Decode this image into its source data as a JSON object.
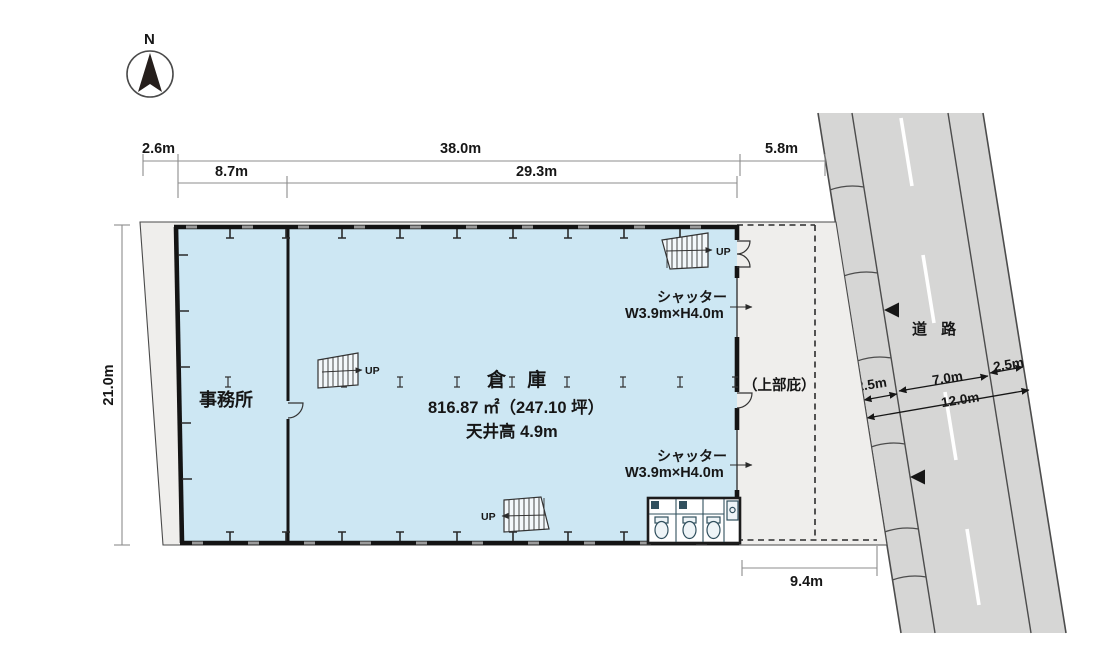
{
  "compass": {
    "label": "N"
  },
  "dims": {
    "site_left_width": "2.6m",
    "building_width": "38.0m",
    "east_gap": "5.8m",
    "office_width": "8.7m",
    "warehouse_width": "29.3m",
    "site_depth": "21.0m",
    "south_gap": "9.4m",
    "road_sidewalk_west": "2.5m",
    "road_carriageway": "7.0m",
    "road_sidewalk_east": "2.5m",
    "road_total": "12.0m"
  },
  "rooms": {
    "office": "事務所",
    "warehouse": "倉 庫",
    "warehouse_area": "816.87 ㎡（247.10 坪）",
    "ceiling": "天井高 4.9m",
    "canopy": "（上部庇）"
  },
  "shutters": [
    {
      "line1": "シャッター",
      "line2": "W3.9m×H4.0m"
    },
    {
      "line1": "シャッター",
      "line2": "W3.9m×H4.0m"
    }
  ],
  "stairs": [
    {
      "label": "UP"
    },
    {
      "label": "UP"
    },
    {
      "label": "UP"
    }
  ],
  "road": {
    "label": "道 路"
  },
  "colors": {
    "building_fill": "#cde7f3",
    "site_fill": "#efeeec",
    "road_fill": "#d6d6d5",
    "wall": "#141414"
  }
}
